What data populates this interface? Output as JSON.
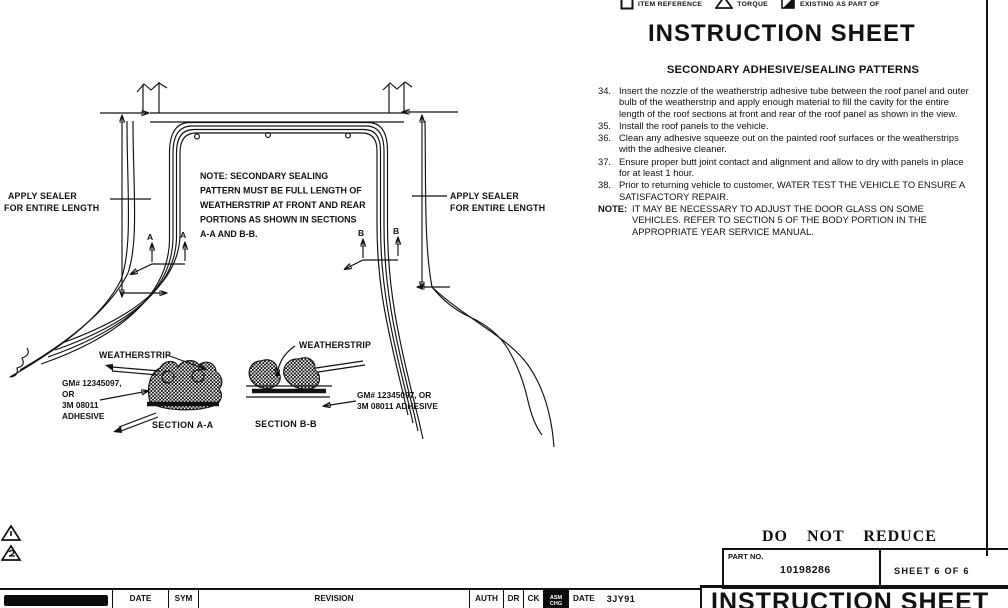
{
  "colors": {
    "ink": "#111111",
    "paper": "#ffffff"
  },
  "legend": {
    "items": [
      {
        "icon": "item-reference-box-icon",
        "label": "ITEM REFERENCE"
      },
      {
        "icon": "torque-triangle-icon",
        "label": "TORQUE"
      },
      {
        "icon": "existing-as-part-of-icon",
        "label": "EXISTING AS PART OF"
      }
    ]
  },
  "header": {
    "title": "INSTRUCTION SHEET"
  },
  "instructions": {
    "heading": "SECONDARY ADHESIVE/SEALING PATTERNS",
    "items": [
      {
        "num": "34.",
        "text": "Insert the nozzle of the weatherstrip adhesive tube between the roof panel and outer bulb of the weatherstrip and apply enough material to fill the cavity for the entire length of the roof sections at front and rear of the roof panel as shown in the view."
      },
      {
        "num": "35.",
        "text": "Install the roof panels to the vehicle."
      },
      {
        "num": "36.",
        "text": "Clean any adhesive squeeze out on the painted roof surfaces or the weatherstrips with the adhesive cleaner."
      },
      {
        "num": "37.",
        "text": "Ensure proper butt joint contact and alignment and allow to dry with panels in place for at least 1 hour."
      },
      {
        "num": "38.",
        "text": "Prior to returning vehicle to customer, WATER TEST THE VEHICLE TO ENSURE A SATISFACTORY REPAIR."
      },
      {
        "num": "NOTE:",
        "text": "IT MAY BE NECESSARY TO ADJUST THE DOOR GLASS ON SOME VEHICLES. REFER TO SECTION 5 OF THE BODY PORTION IN THE APPROPRIATE YEAR SERVICE MANUAL."
      }
    ]
  },
  "diagram": {
    "note_lines": [
      "NOTE: SECONDARY SEALING",
      "PATTERN MUST BE FULL LENGTH OF",
      "WEATHERSTRIP AT FRONT AND REAR",
      "PORTIONS AS SHOWN IN SECTIONS",
      "A-A AND B-B."
    ],
    "apply_sealer_left": [
      "APPLY SEALER",
      "FOR ENTIRE LENGTH"
    ],
    "apply_sealer_right": [
      "APPLY SEALER",
      "FOR ENTIRE LENGTH"
    ],
    "cut_a": "A",
    "cut_b": "B",
    "weatherstrip_a": "WEATHERSTRIP",
    "weatherstrip_b": "WEATHERSTRIP",
    "adhesive_a": [
      "GM# 12345097,",
      "OR",
      "3M 08011",
      "ADHESIVE"
    ],
    "adhesive_b": [
      "GM# 12345097, OR",
      "3M 08011 ADHESIVE"
    ],
    "section_a": "SECTION A-A",
    "section_b": "SECTION B-B"
  },
  "footer": {
    "do_not_reduce": "DO NOT REDUCE",
    "part_no_label": "PART NO.",
    "part_no": "10198286",
    "sheet": "SHEET 6 OF 6",
    "title": "INSTRUCTION SHEET",
    "table": {
      "date": "DATE",
      "sym": "SYM",
      "revision": "REVISION",
      "auth": "AUTH",
      "dr": "DR",
      "ck": "CK",
      "asm_line1": "ASM",
      "asm_line2": "CHG",
      "date2": "DATE",
      "date_value": "3JY91"
    }
  }
}
